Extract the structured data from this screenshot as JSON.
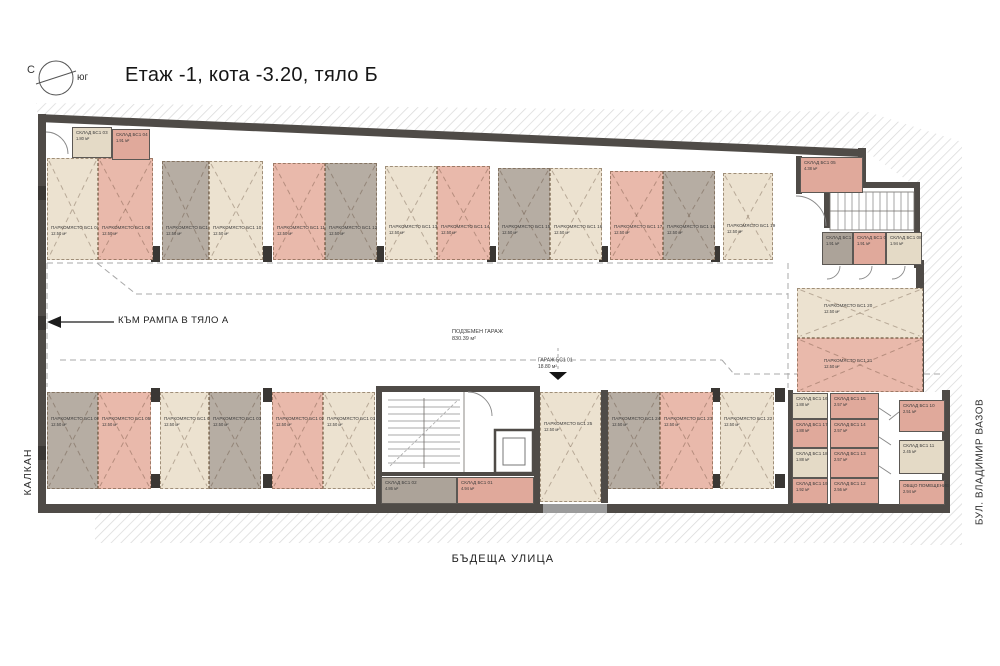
{
  "page": {
    "title": "Етаж -1, кота -3.20, тяло Б"
  },
  "compass": {
    "north": "С",
    "south": "юг"
  },
  "annotations": {
    "ramp": "КЪМ РАМПА В ТЯЛО А",
    "garage_name": "ПОДЗЕМЕН ГАРАЖ",
    "garage_area": "830.39 м²",
    "entry_label": "ГАРАЖ БС1 01",
    "entry_area": "18.80 м²",
    "street_bottom": "БЪДЕЩА УЛИЦА",
    "street_right": "БУЛ. ВЛАДИМИР ВАЗОВ",
    "wall_left": "КАЛКАН"
  },
  "legend_colors": {
    "parking_beige": "#ece2d0",
    "parking_pink": "#e9b9ab",
    "parking_gray": "#b6ada3",
    "storage_beige": "#e4dac6",
    "storage_pink": "#e0a99b",
    "storage_gray": "#aca399",
    "wall": "#4f4b47"
  },
  "rooms": [
    {
      "kind": "parking",
      "label": "ПАРКОМЯСТО БС1 07",
      "area": "12.50 м²",
      "color": "beige",
      "x": 47,
      "y": 158,
      "w": 51,
      "h": 102,
      "lp": 66
    },
    {
      "kind": "parking",
      "label": "ПАРКОМЯСТО БС1 08",
      "area": "12.50 м²",
      "color": "pink",
      "x": 98,
      "y": 158,
      "w": 55,
      "h": 102,
      "lp": 66
    },
    {
      "kind": "parking",
      "label": "ПАРКОМЯСТО БС1 09",
      "area": "12.50 м²",
      "color": "gray",
      "x": 162,
      "y": 161,
      "w": 47,
      "h": 99,
      "lp": 65
    },
    {
      "kind": "parking",
      "label": "ПАРКОМЯСТО БС1 10",
      "area": "12.50 м²",
      "color": "beige",
      "x": 209,
      "y": 161,
      "w": 54,
      "h": 99,
      "lp": 65
    },
    {
      "kind": "parking",
      "label": "ПАРКОМЯСТО БС1 11",
      "area": "12.50 м²",
      "color": "pink",
      "x": 273,
      "y": 163,
      "w": 52,
      "h": 97,
      "lp": 64
    },
    {
      "kind": "parking",
      "label": "ПАРКОМЯСТО БС1 12",
      "area": "12.50 м²",
      "color": "gray",
      "x": 325,
      "y": 163,
      "w": 52,
      "h": 97,
      "lp": 64
    },
    {
      "kind": "parking",
      "label": "ПАРКОМЯСТО БС1 13",
      "area": "12.50 м²",
      "color": "beige",
      "x": 385,
      "y": 166,
      "w": 52,
      "h": 94,
      "lp": 62
    },
    {
      "kind": "parking",
      "label": "ПАРКОМЯСТО БС1 14",
      "area": "12.50 м²",
      "color": "pink",
      "x": 437,
      "y": 166,
      "w": 53,
      "h": 94,
      "lp": 62
    },
    {
      "kind": "parking",
      "label": "ПАРКОМЯСТО БС1 15",
      "area": "12.50 м²",
      "color": "gray",
      "x": 498,
      "y": 168,
      "w": 52,
      "h": 92,
      "lp": 61
    },
    {
      "kind": "parking",
      "label": "ПАРКОМЯСТО БС1 16",
      "area": "12.50 м²",
      "color": "beige",
      "x": 550,
      "y": 168,
      "w": 52,
      "h": 92,
      "lp": 61
    },
    {
      "kind": "parking",
      "label": "ПАРКОМЯСТО БС1 17",
      "area": "12.50 м²",
      "color": "pink",
      "x": 610,
      "y": 171,
      "w": 53,
      "h": 89,
      "lp": 60
    },
    {
      "kind": "parking",
      "label": "ПАРКОМЯСТО БС1 18",
      "area": "12.50 м²",
      "color": "gray",
      "x": 663,
      "y": 171,
      "w": 52,
      "h": 89,
      "lp": 60
    },
    {
      "kind": "parking",
      "label": "ПАРКОМЯСТО БС1 19",
      "area": "12.50 м²",
      "color": "beige",
      "x": 723,
      "y": 173,
      "w": 50,
      "h": 87,
      "lp": 58
    },
    {
      "kind": "parking",
      "label": "ПАРКОМЯСТО БС1 20",
      "area": "12.50 м²",
      "color": "beige",
      "x": 797,
      "y": 288,
      "w": 126,
      "h": 50,
      "lp": 30,
      "indent": 26
    },
    {
      "kind": "parking",
      "label": "ПАРКОМЯСТО БС1 21",
      "area": "12.50 м²",
      "color": "pink",
      "x": 797,
      "y": 338,
      "w": 126,
      "h": 54,
      "lp": 36,
      "indent": 26
    },
    {
      "kind": "parking",
      "label": "ПАРКОМЯСТО БС1 06",
      "area": "12.50 м²",
      "color": "gray",
      "x": 47,
      "y": 392,
      "w": 51,
      "h": 97,
      "lp": 24
    },
    {
      "kind": "parking",
      "label": "ПАРКОМЯСТО БС1 05",
      "area": "12.50 м²",
      "color": "pink",
      "x": 98,
      "y": 392,
      "w": 53,
      "h": 97,
      "lp": 24
    },
    {
      "kind": "parking",
      "label": "ПАРКОМЯСТО БС1 04",
      "area": "12.50 м²",
      "color": "beige",
      "x": 160,
      "y": 392,
      "w": 49,
      "h": 97,
      "lp": 24
    },
    {
      "kind": "parking",
      "label": "ПАРКОМЯСТО БС1 03",
      "area": "12.50 м²",
      "color": "gray",
      "x": 209,
      "y": 392,
      "w": 52,
      "h": 97,
      "lp": 24
    },
    {
      "kind": "parking",
      "label": "ПАРКОМЯСТО БС1 02",
      "area": "12.50 м²",
      "color": "pink",
      "x": 272,
      "y": 392,
      "w": 51,
      "h": 97,
      "lp": 24
    },
    {
      "kind": "parking",
      "label": "ПАРКОМЯСТО БС1 01",
      "area": "12.50 м²",
      "color": "beige",
      "x": 323,
      "y": 392,
      "w": 52,
      "h": 97,
      "lp": 24
    },
    {
      "kind": "parking",
      "label": "ПАРКОМЯСТО БС1 25",
      "area": "12.50 м²",
      "color": "beige",
      "x": 540,
      "y": 392,
      "w": 61,
      "h": 110,
      "lp": 26
    },
    {
      "kind": "parking",
      "label": "ПАРКОМЯСТО БС1 24",
      "area": "12.50 м²",
      "color": "gray",
      "x": 608,
      "y": 392,
      "w": 52,
      "h": 97,
      "lp": 24
    },
    {
      "kind": "parking",
      "label": "ПАРКОМЯСТО БС1 23",
      "area": "12.50 м²",
      "color": "pink",
      "x": 660,
      "y": 392,
      "w": 53,
      "h": 97,
      "lp": 24
    },
    {
      "kind": "parking",
      "label": "ПАРКОМЯСТО БС1 22",
      "area": "12.50 м²",
      "color": "beige",
      "x": 720,
      "y": 392,
      "w": 54,
      "h": 97,
      "lp": 24
    },
    {
      "kind": "storage",
      "label": "СКЛАД БС1 03",
      "area": "1.80 м²",
      "color": "stbeige",
      "x": 72,
      "y": 127,
      "w": 40,
      "h": 31
    },
    {
      "kind": "storage",
      "label": "СКЛАД БС1 04",
      "area": "1.91 м²",
      "color": "stpink",
      "x": 112,
      "y": 129,
      "w": 38,
      "h": 31
    },
    {
      "kind": "storage",
      "label": "СКЛАД БС1 05",
      "area": "4.38 м²",
      "color": "stpink",
      "x": 800,
      "y": 157,
      "w": 63,
      "h": 36
    },
    {
      "kind": "storage",
      "label": "СКЛАД БС1 06",
      "area": "1.91 м²",
      "color": "stgray",
      "x": 822,
      "y": 232,
      "w": 31,
      "h": 33
    },
    {
      "kind": "storage",
      "label": "СКЛАД БС1 07",
      "area": "1.91 м²",
      "color": "stpink",
      "x": 853,
      "y": 232,
      "w": 33,
      "h": 33
    },
    {
      "kind": "storage",
      "label": "СКЛАД БС1 08",
      "area": "1.94 м²",
      "color": "stbeige",
      "x": 886,
      "y": 232,
      "w": 36,
      "h": 33
    },
    {
      "kind": "storage",
      "label": "СКЛАД БС1 02",
      "area": "4.86 м²",
      "color": "stgray",
      "x": 381,
      "y": 477,
      "w": 76,
      "h": 27
    },
    {
      "kind": "storage",
      "label": "СКЛАД БС1 01",
      "area": "4.94 м²",
      "color": "stpink",
      "x": 457,
      "y": 477,
      "w": 77,
      "h": 27
    },
    {
      "kind": "storage",
      "label": "СКЛАД БС1 16",
      "area": "1.88 м²",
      "color": "stbeige",
      "x": 792,
      "y": 393,
      "w": 36,
      "h": 26
    },
    {
      "kind": "storage",
      "label": "СКЛАД БС1 17",
      "area": "1.88 м²",
      "color": "stpink",
      "x": 792,
      "y": 419,
      "w": 36,
      "h": 29
    },
    {
      "kind": "storage",
      "label": "СКЛАД БС1 18",
      "area": "1.88 м²",
      "color": "stbeige",
      "x": 792,
      "y": 448,
      "w": 36,
      "h": 30
    },
    {
      "kind": "storage",
      "label": "СКЛАД БС1 19",
      "area": "1.92 м²",
      "color": "stpink",
      "x": 792,
      "y": 478,
      "w": 36,
      "h": 26
    },
    {
      "kind": "storage",
      "label": "СКЛАД БС1 15",
      "area": "2.57 м²",
      "color": "stpink",
      "x": 830,
      "y": 393,
      "w": 49,
      "h": 26
    },
    {
      "kind": "storage",
      "label": "СКЛАД БС1 14",
      "area": "2.57 м²",
      "color": "stpink",
      "x": 830,
      "y": 419,
      "w": 49,
      "h": 29
    },
    {
      "kind": "storage",
      "label": "СКЛАД БС1 13",
      "area": "2.57 м²",
      "color": "stpink",
      "x": 830,
      "y": 448,
      "w": 49,
      "h": 30
    },
    {
      "kind": "storage",
      "label": "СКЛАД БС1 12",
      "area": "2.56 м²",
      "color": "stpink",
      "x": 830,
      "y": 478,
      "w": 49,
      "h": 26
    },
    {
      "kind": "storage",
      "label": "СКЛАД БС1 10",
      "area": "2.51 м²",
      "color": "stpink",
      "x": 899,
      "y": 400,
      "w": 46,
      "h": 32
    },
    {
      "kind": "storage",
      "label": "СКЛАД БС1 11",
      "area": "2.45 м²",
      "color": "stbeige",
      "x": 899,
      "y": 440,
      "w": 46,
      "h": 34
    },
    {
      "kind": "storage",
      "label": "ОБЩО ПОМЕЩЕНИЕ",
      "area": "2.94 м²",
      "color": "stpink",
      "x": 899,
      "y": 480,
      "w": 46,
      "h": 25
    }
  ]
}
